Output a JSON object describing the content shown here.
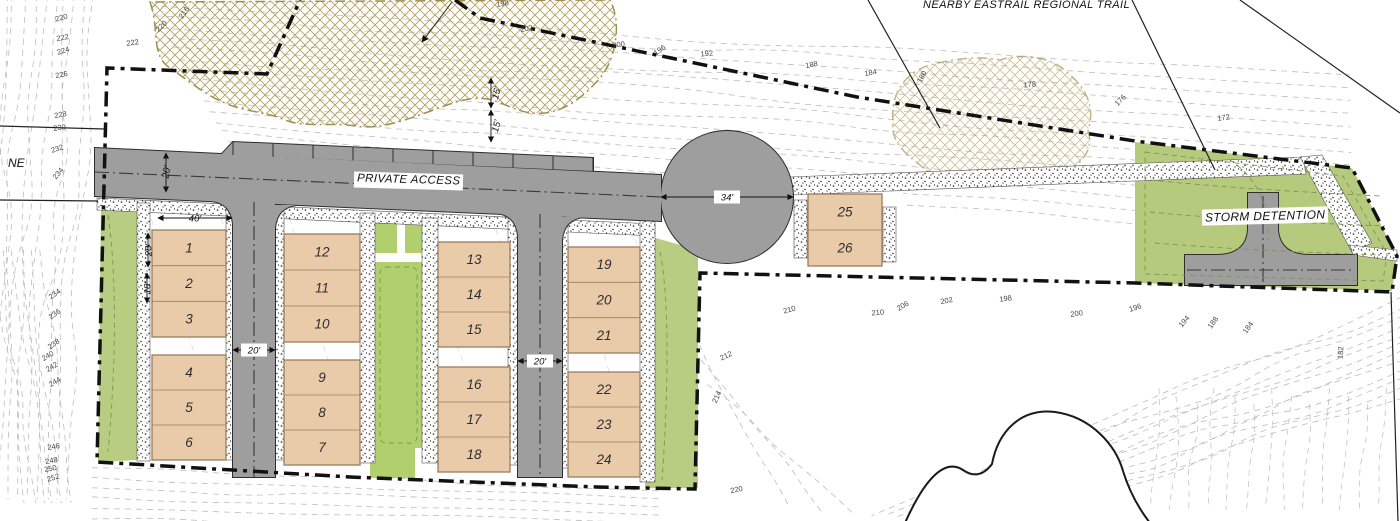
{
  "labels": {
    "nearby_trail": "NEARBY EASTRAIL REGIONAL TRAIL",
    "private_access": "PRIVATE ACCESS",
    "storm_detention": "STORM DETENTION",
    "street_partial": "NE"
  },
  "lot_blocks": [
    {
      "name": "block-1-3",
      "units": [
        "1",
        "2",
        "3"
      ]
    },
    {
      "name": "block-4-6",
      "units": [
        "4",
        "5",
        "6"
      ]
    },
    {
      "name": "block-10-12",
      "units": [
        "12",
        "11",
        "10"
      ]
    },
    {
      "name": "block-7-9",
      "units": [
        "9",
        "8",
        "7"
      ]
    },
    {
      "name": "block-13-15",
      "units": [
        "13",
        "14",
        "15"
      ]
    },
    {
      "name": "block-16-18",
      "units": [
        "16",
        "17",
        "18"
      ]
    },
    {
      "name": "block-19-21",
      "units": [
        "19",
        "20",
        "21"
      ]
    },
    {
      "name": "block-22-24",
      "units": [
        "22",
        "23",
        "24"
      ]
    },
    {
      "name": "block-25-26",
      "units": [
        "25",
        "26"
      ]
    }
  ],
  "dimensions": [
    {
      "name": "lot-block-width",
      "label": "40'"
    },
    {
      "name": "front-setback",
      "label": "20'"
    },
    {
      "name": "unit-depth",
      "label": "18'"
    },
    {
      "name": "access-road-width",
      "label": "20'"
    },
    {
      "name": "west-drive-aisle-width",
      "label": "20'"
    },
    {
      "name": "east-drive-aisle-width",
      "label": "20'"
    },
    {
      "name": "culdesac-width",
      "label": "34'"
    },
    {
      "name": "buffer-upper",
      "label": "15'"
    },
    {
      "name": "buffer-lower",
      "label": "15'"
    }
  ],
  "contour_labels": [
    {
      "v": "220",
      "x": 62,
      "y": 20,
      "r": -15
    },
    {
      "v": "222",
      "x": 63,
      "y": 40,
      "r": -10
    },
    {
      "v": "224",
      "x": 64,
      "y": 53,
      "r": -18
    },
    {
      "v": "226",
      "x": 62,
      "y": 77,
      "r": -12
    },
    {
      "v": "222",
      "x": 133,
      "y": 45,
      "r": -8
    },
    {
      "v": "216",
      "x": 186,
      "y": 14,
      "r": -55
    },
    {
      "v": "220",
      "x": 163,
      "y": 28,
      "r": -45
    },
    {
      "v": "228",
      "x": 61,
      "y": 117,
      "r": -12
    },
    {
      "v": "230",
      "x": 60,
      "y": 130,
      "r": -8
    },
    {
      "v": "232",
      "x": 58,
      "y": 151,
      "r": -18
    },
    {
      "v": "234",
      "x": 60,
      "y": 175,
      "r": -50
    },
    {
      "v": "234",
      "x": 56,
      "y": 296,
      "r": -35
    },
    {
      "v": "236",
      "x": 56,
      "y": 316,
      "r": -35
    },
    {
      "v": "238",
      "x": 55,
      "y": 346,
      "r": -35
    },
    {
      "v": "240",
      "x": 49,
      "y": 358,
      "r": -30
    },
    {
      "v": "242",
      "x": 53,
      "y": 369,
      "r": -30
    },
    {
      "v": "244",
      "x": 56,
      "y": 384,
      "r": -30
    },
    {
      "v": "246",
      "x": 54,
      "y": 449,
      "r": -10
    },
    {
      "v": "248",
      "x": 52,
      "y": 463,
      "r": -12
    },
    {
      "v": "250",
      "x": 51,
      "y": 471,
      "r": -12
    },
    {
      "v": "252",
      "x": 54,
      "y": 480,
      "r": -18
    },
    {
      "v": "198",
      "x": 503,
      "y": 6,
      "r": -10
    },
    {
      "v": "202",
      "x": 527,
      "y": 31,
      "r": -12
    },
    {
      "v": "200",
      "x": 619,
      "y": 47,
      "r": -8
    },
    {
      "v": "196",
      "x": 661,
      "y": 52,
      "r": -35
    },
    {
      "v": "192",
      "x": 707,
      "y": 56,
      "r": -5
    },
    {
      "v": "188",
      "x": 812,
      "y": 67,
      "r": -12
    },
    {
      "v": "184",
      "x": 871,
      "y": 75,
      "r": -10
    },
    {
      "v": "180",
      "x": 924,
      "y": 78,
      "r": -60
    },
    {
      "v": "178",
      "x": 1030,
      "y": 87,
      "r": -5
    },
    {
      "v": "176",
      "x": 1122,
      "y": 102,
      "r": -45
    },
    {
      "v": "172",
      "x": 1224,
      "y": 120,
      "r": -8
    },
    {
      "v": "210",
      "x": 790,
      "y": 312,
      "r": -15
    },
    {
      "v": "210",
      "x": 878,
      "y": 315,
      "r": -5
    },
    {
      "v": "206",
      "x": 904,
      "y": 308,
      "r": -30
    },
    {
      "v": "202",
      "x": 947,
      "y": 303,
      "r": -10
    },
    {
      "v": "198",
      "x": 1006,
      "y": 301,
      "r": -8
    },
    {
      "v": "200",
      "x": 1077,
      "y": 316,
      "r": -8
    },
    {
      "v": "212",
      "x": 727,
      "y": 358,
      "r": -25
    },
    {
      "v": "214",
      "x": 719,
      "y": 398,
      "r": -65
    },
    {
      "v": "220",
      "x": 737,
      "y": 492,
      "r": -12
    },
    {
      "v": "196",
      "x": 1136,
      "y": 310,
      "r": -18
    },
    {
      "v": "194",
      "x": 1186,
      "y": 323,
      "r": -50
    },
    {
      "v": "188",
      "x": 1215,
      "y": 324,
      "r": -55
    },
    {
      "v": "184",
      "x": 1250,
      "y": 329,
      "r": -55
    },
    {
      "v": "182",
      "x": 1343,
      "y": 353,
      "r": -85
    }
  ],
  "colors": {
    "road": "#9e9e9e",
    "building": "#e9cbaa",
    "green_buffer": "#b8cc82",
    "green_courtyard": "#b2cf6d",
    "green_detention": "#b5ca7c",
    "canopy": "#b2a05c",
    "boundary": "#111111"
  }
}
